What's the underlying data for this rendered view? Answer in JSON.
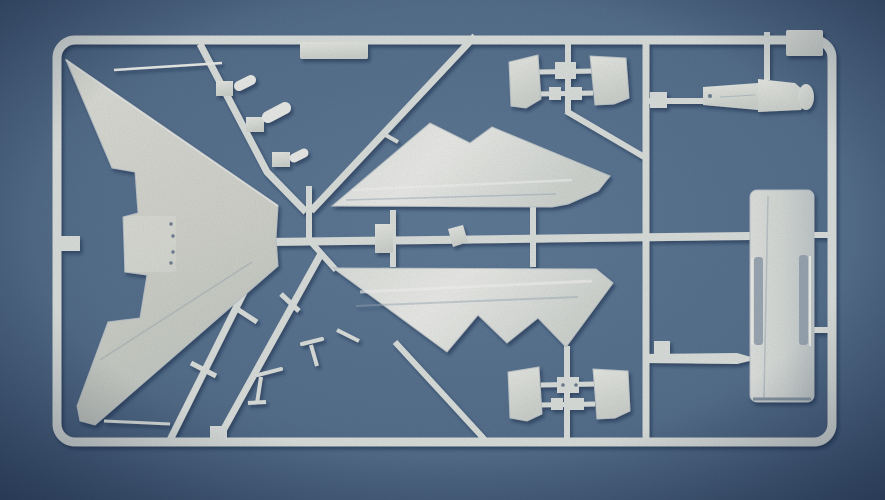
{
  "meta": {
    "subject": "photograph of a white plastic model-kit sprue with aircraft parts on a blue background",
    "parts_visible": [
      "delta-wing",
      "upper-fuselage-half",
      "lower-fuselage-half",
      "intake-ramp-panels",
      "drop-tank-slab",
      "pylon-body",
      "landing-gear-struts",
      "small-clip-parts",
      "sprue-frame-runners"
    ]
  },
  "palette": {
    "plastic": "#e4e9e6",
    "plasticBright": "#f4f6f2",
    "dot": "#76869a",
    "bgCenter": "#64809f",
    "bgMid": "#597492",
    "bgEdge": "#42597a",
    "shadow": "#16294a"
  },
  "shapes": [
    {
      "name": "photo-background",
      "l": "bg",
      "t": "rect",
      "x": 0,
      "y": 0,
      "w": 885,
      "h": 500,
      "f": "bgGrad"
    },
    {
      "name": "sprue-frame-outline",
      "t": "rect",
      "x": 57,
      "y": 40,
      "w": 775,
      "h": 402,
      "rx": 18,
      "f": "none",
      "k": "plastic",
      "sw": 9
    },
    {
      "name": "frame-gate-stub",
      "t": "rect",
      "x": 56,
      "y": 236,
      "w": 24,
      "h": 15,
      "f": "plastic"
    },
    {
      "name": "label-plate",
      "t": "rect",
      "x": 300,
      "y": 42,
      "w": 68,
      "h": 17,
      "rx": 2,
      "f": "partGrad"
    },
    {
      "name": "corner-plate",
      "t": "rect",
      "x": 786,
      "y": 30,
      "w": 37,
      "h": 26,
      "rx": 2,
      "f": "partGrad"
    },
    {
      "name": "runner-diagonal-left",
      "t": "polyline",
      "pts": "200,44 267,172 306,212",
      "sw": 7
    },
    {
      "name": "runner-diagonal-right",
      "t": "line",
      "x1": 475,
      "y1": 36,
      "x2": 311,
      "y2": 211,
      "sw": 7
    },
    {
      "name": "runner-gate-stub-r2",
      "t": "line",
      "x1": 382,
      "y1": 133,
      "x2": 398,
      "y2": 142,
      "sw": 4
    },
    {
      "name": "junction-stub",
      "t": "line",
      "x1": 309,
      "y1": 186,
      "x2": 309,
      "y2": 243,
      "sw": 6
    },
    {
      "name": "runner-main-horizontal",
      "t": "line",
      "x1": 268,
      "y1": 242,
      "x2": 750,
      "y2": 236,
      "sw": 8
    },
    {
      "name": "runner-lower-fuselage-link",
      "t": "line",
      "x1": 310,
      "y1": 241,
      "x2": 336,
      "y2": 270,
      "sw": 6
    },
    {
      "name": "runner-rail-b",
      "t": "line",
      "x1": 322,
      "y1": 252,
      "x2": 220,
      "y2": 436,
      "sw": 7
    },
    {
      "name": "runner-rail-a",
      "t": "line",
      "x1": 265,
      "y1": 250,
      "x2": 170,
      "y2": 440,
      "sw": 7
    },
    {
      "name": "rail-rung-1",
      "t": "line",
      "x1": 281,
      "y1": 294,
      "x2": 299,
      "y2": 311,
      "sw": 5
    },
    {
      "name": "rail-rung-2",
      "t": "line",
      "x1": 237,
      "y1": 309,
      "x2": 257,
      "y2": 322,
      "sw": 5
    },
    {
      "name": "rail-rung-3",
      "t": "line",
      "x1": 191,
      "y1": 363,
      "x2": 216,
      "y2": 376,
      "sw": 5
    },
    {
      "name": "frame-bottom-block",
      "t": "rect",
      "x": 210,
      "y": 426,
      "w": 17,
      "h": 15,
      "f": "plastic"
    },
    {
      "name": "wingtip-gate",
      "t": "line",
      "x1": 104,
      "y1": 421,
      "x2": 170,
      "y2": 424,
      "sw": 3
    },
    {
      "name": "runner-vertical-intake-top",
      "t": "line",
      "x1": 568,
      "y1": 38,
      "x2": 568,
      "y2": 112,
      "sw": 6
    },
    {
      "name": "runner-diag-568-646",
      "t": "line",
      "x1": 566,
      "y1": 111,
      "x2": 646,
      "y2": 158,
      "sw": 6
    },
    {
      "name": "runner-vertical-intake-bottom",
      "t": "line",
      "x1": 567,
      "y1": 346,
      "x2": 567,
      "y2": 441,
      "sw": 6
    },
    {
      "name": "runner-vertical-right",
      "t": "line",
      "x1": 646,
      "y1": 42,
      "x2": 646,
      "y2": 440,
      "sw": 7
    },
    {
      "name": "runner-vertical-pylon",
      "t": "line",
      "x1": 767,
      "y1": 32,
      "x2": 767,
      "y2": 80,
      "sw": 6
    },
    {
      "name": "runner-diag-bottom-right",
      "t": "line",
      "x1": 395,
      "y1": 342,
      "x2": 486,
      "y2": 441,
      "sw": 6
    },
    {
      "name": "fuselage-stub-1",
      "t": "line",
      "x1": 393,
      "y1": 210,
      "x2": 393,
      "y2": 238,
      "sw": 6
    },
    {
      "name": "fuselage-stub-2",
      "t": "line",
      "x1": 393,
      "y1": 242,
      "x2": 393,
      "y2": 267,
      "sw": 6
    },
    {
      "name": "fuselage-stub-3",
      "t": "line",
      "x1": 533,
      "y1": 207,
      "x2": 533,
      "y2": 238,
      "sw": 6
    },
    {
      "name": "fuselage-stub-4",
      "t": "line",
      "x1": 533,
      "y1": 242,
      "x2": 533,
      "y2": 267,
      "sw": 6
    },
    {
      "name": "pylon-stub",
      "t": "line",
      "x1": 648,
      "y1": 101,
      "x2": 704,
      "y2": 101,
      "sw": 6
    },
    {
      "name": "pylon-stub-block",
      "t": "rect",
      "x": 650,
      "y": 92,
      "w": 17,
      "h": 16,
      "f": "plastic"
    },
    {
      "name": "slab-link-top",
      "t": "line",
      "x1": 812,
      "y1": 235,
      "x2": 831,
      "y2": 235,
      "sw": 6
    },
    {
      "name": "slab-link-mid",
      "t": "line",
      "x1": 812,
      "y1": 330,
      "x2": 831,
      "y2": 330,
      "sw": 6
    },
    {
      "name": "missile-runner",
      "t": "polygon",
      "pts": "646,354 737,353 758,359 737,364 646,363",
      "f": "plastic"
    },
    {
      "name": "missile-runner-block",
      "t": "rect",
      "x": 654,
      "y": 341,
      "w": 16,
      "h": 14,
      "f": "plastic"
    },
    {
      "name": "intake-top-bar-1",
      "t": "line",
      "x1": 539,
      "y1": 72,
      "x2": 593,
      "y2": 71,
      "sw": 5
    },
    {
      "name": "intake-top-block-1",
      "t": "rect",
      "x": 555,
      "y": 62,
      "w": 21,
      "h": 17,
      "f": "plastic"
    },
    {
      "name": "intake-top-bar-2",
      "t": "line",
      "x1": 539,
      "y1": 94,
      "x2": 593,
      "y2": 93,
      "sw": 5
    },
    {
      "name": "intake-top-block-2",
      "t": "rect",
      "x": 549,
      "y": 87,
      "w": 12,
      "h": 13,
      "f": "plastic"
    },
    {
      "name": "intake-top-block-3",
      "t": "rect",
      "x": 567,
      "y": 87,
      "w": 15,
      "h": 13,
      "f": "plastic"
    },
    {
      "name": "intake-bottom-bar-1",
      "t": "line",
      "x1": 541,
      "y1": 385,
      "x2": 595,
      "y2": 384,
      "sw": 5
    },
    {
      "name": "intake-bottom-block-1",
      "t": "rect",
      "x": 557,
      "y": 377,
      "w": 22,
      "h": 16,
      "f": "plastic"
    },
    {
      "name": "intake-bottom-bar-2",
      "t": "line",
      "x1": 541,
      "y1": 405,
      "x2": 595,
      "y2": 404,
      "sw": 5
    },
    {
      "name": "intake-bottom-block-2",
      "t": "rect",
      "x": 551,
      "y": 398,
      "w": 12,
      "h": 12,
      "f": "plastic"
    },
    {
      "name": "intake-bottom-block-3",
      "t": "rect",
      "x": 569,
      "y": 398,
      "w": 15,
      "h": 12,
      "f": "plastic"
    },
    {
      "name": "clip-part-1-block",
      "t": "rect",
      "x": 216,
      "y": 81,
      "w": 17,
      "h": 15,
      "f": "partGrad"
    },
    {
      "name": "clip-part-1-nub",
      "t": "line",
      "x1": 239,
      "y1": 86,
      "x2": 251,
      "y2": 80,
      "sw": 10,
      "cap": "round",
      "k": "plasticBright"
    },
    {
      "name": "clip-part-2-block",
      "t": "rect",
      "x": 246,
      "y": 117,
      "w": 18,
      "h": 15,
      "f": "partGrad"
    },
    {
      "name": "clip-part-2-nub",
      "t": "line",
      "x1": 268,
      "y1": 117,
      "x2": 285,
      "y2": 108,
      "sw": 12,
      "cap": "round",
      "k": "plasticBright"
    },
    {
      "name": "clip-part-3-block",
      "t": "rect",
      "x": 272,
      "y": 152,
      "w": 18,
      "h": 15,
      "f": "partGrad"
    },
    {
      "name": "clip-part-3-nub",
      "t": "line",
      "x1": 294,
      "y1": 158,
      "x2": 304,
      "y2": 153,
      "sw": 9,
      "cap": "round",
      "k": "plasticBright"
    },
    {
      "name": "delta-wing-part",
      "t": "polygon",
      "pts": "66,60 278,206 276,238 278,266 95,425 80,421 77,406 108,322 140,318 147,275 125,272 123,217 138,213 135,172 112,168",
      "f": "wingGrad",
      "k": "#c3ccd2",
      "sw": 1
    },
    {
      "name": "wing-center-panel",
      "t": "rect",
      "x": 124,
      "y": 216,
      "w": 52,
      "h": 56,
      "f": "#ffffff",
      "o": 0.22
    },
    {
      "name": "wing-hole-1",
      "t": "circle",
      "cx": 171,
      "cy": 224,
      "r": 1.7,
      "f": "dot"
    },
    {
      "name": "wing-hole-2",
      "t": "circle",
      "cx": 173,
      "cy": 236,
      "r": 1.7,
      "f": "dot"
    },
    {
      "name": "wing-hole-3",
      "t": "circle",
      "cx": 173,
      "cy": 252,
      "r": 1.7,
      "f": "dot"
    },
    {
      "name": "wing-hole-4",
      "t": "circle",
      "cx": 171,
      "cy": 263,
      "r": 1.7,
      "f": "dot"
    },
    {
      "name": "wing-leading-edge-highlight",
      "t": "line",
      "x1": 66,
      "y1": 60,
      "x2": 278,
      "y2": 206,
      "k": "#f8faf6",
      "sw": 2,
      "o": 0.75
    },
    {
      "name": "wing-crease",
      "t": "line",
      "x1": 100,
      "y1": 360,
      "x2": 252,
      "y2": 262,
      "k": "#8fa0b0",
      "sw": 1.5,
      "o": 0.35
    },
    {
      "name": "pitot-probe-part",
      "t": "line",
      "x1": 114,
      "y1": 70,
      "x2": 222,
      "y2": 63,
      "sw": 2.5,
      "k": "plasticBright"
    },
    {
      "name": "upper-fuselage-half-part",
      "t": "polygon",
      "pts": "332,206 430,123 470,143 492,127 610,176 598,191 568,204 552,207",
      "f": "sheenGrad",
      "k": "#c9d1d5",
      "sw": 1
    },
    {
      "name": "upper-fuselage-sheen",
      "t": "line",
      "x1": 352,
      "y1": 190,
      "x2": 572,
      "y2": 180,
      "k": "#ffffff",
      "sw": 2.5,
      "o": 0.55
    },
    {
      "name": "upper-fuselage-shadow-line",
      "t": "line",
      "x1": 346,
      "y1": 200,
      "x2": 556,
      "y2": 194,
      "k": "#9fb0bd",
      "sw": 1.5,
      "o": 0.5
    },
    {
      "name": "scoop-part",
      "t": "polygon",
      "pts": "448,229 463,225 468,242 453,247",
      "f": "partGrad"
    },
    {
      "name": "junction-block-part",
      "t": "rect",
      "x": 375,
      "y": 224,
      "w": 18,
      "h": 29,
      "f": "partGrad"
    },
    {
      "name": "lower-fuselage-half-part",
      "t": "polygon",
      "pts": "333,268 596,269 613,283 566,347 538,318 507,343 478,315 447,352",
      "f": "sheenGrad",
      "k": "#c9d1d5",
      "sw": 1
    },
    {
      "name": "lower-fuselage-sheen",
      "t": "line",
      "x1": 360,
      "y1": 292,
      "x2": 592,
      "y2": 281,
      "k": "#ffffff",
      "sw": 3,
      "o": 0.6
    },
    {
      "name": "lower-fuselage-shadow-line",
      "t": "line",
      "x1": 356,
      "y1": 306,
      "x2": 578,
      "y2": 297,
      "k": "#9fb0bd",
      "sw": 2,
      "o": 0.45
    },
    {
      "name": "intake-panel-top-left",
      "t": "polygon",
      "pts": "509,62 538,55 541,99 526,108 511,106",
      "f": "partGrad",
      "k": "#c9d1d5",
      "sw": 1
    },
    {
      "name": "intake-panel-top-right",
      "t": "polygon",
      "pts": "590,56 626,58 629,98 614,104 595,105",
      "f": "partGrad",
      "k": "#c9d1d5",
      "sw": 1
    },
    {
      "name": "intake-panel-bottom-left",
      "t": "polygon",
      "pts": "508,372 539,367 542,414 527,421 510,418",
      "f": "partGrad",
      "k": "#c9d1d5",
      "sw": 1
    },
    {
      "name": "intake-panel-bottom-right",
      "t": "polygon",
      "pts": "593,369 628,371 630,411 615,418 597,419",
      "f": "partGrad",
      "k": "#c9d1d5",
      "sw": 1
    },
    {
      "name": "intake-hole-1",
      "t": "circle",
      "cx": 563,
      "cy": 385,
      "r": 1.8,
      "f": "dot"
    },
    {
      "name": "intake-hole-2",
      "t": "circle",
      "cx": 576,
      "cy": 385,
      "r": 1.8,
      "f": "dot"
    },
    {
      "name": "pylon-bar-part",
      "t": "polygon",
      "pts": "703,87 758,83 758,110 703,105",
      "f": "partGrad"
    },
    {
      "name": "pylon-hole",
      "t": "circle",
      "cx": 710,
      "cy": 96,
      "r": 2,
      "f": "dot"
    },
    {
      "name": "pylon-body-part",
      "t": "polygon",
      "pts": "758,79 795,83 803,90 806,100 801,110 758,112",
      "f": "partGrad"
    },
    {
      "name": "pylon-nose",
      "t": "ellipse",
      "cx": 806,
      "cy": 97,
      "erx": 8,
      "ery": 13,
      "f": "partGrad"
    },
    {
      "name": "pylon-detail-line",
      "t": "line",
      "x1": 720,
      "y1": 97,
      "x2": 755,
      "y2": 95,
      "k": "#9fb0bd",
      "sw": 1,
      "o": 0.6
    },
    {
      "name": "drop-tank-slab-part",
      "t": "rect",
      "x": 750,
      "y": 190,
      "w": 64,
      "h": 212,
      "rx": 7,
      "f": "slabGrad",
      "k": "#c3ccd2",
      "sw": 1
    },
    {
      "name": "slab-groove-left",
      "t": "rect",
      "x": 754,
      "y": 257,
      "w": 9,
      "h": 88,
      "rx": 3,
      "f": "#96a5b4",
      "o": 0.85
    },
    {
      "name": "slab-groove-right",
      "t": "rect",
      "x": 799,
      "y": 255,
      "w": 9,
      "h": 90,
      "rx": 3,
      "f": "#96a5b4",
      "o": 0.85
    },
    {
      "name": "slab-strip-left",
      "t": "line",
      "x1": 752,
      "y1": 258,
      "x2": 752,
      "y2": 345,
      "k": "#f6f8f4",
      "sw": 2
    },
    {
      "name": "slab-strip-right",
      "t": "line",
      "x1": 810,
      "y1": 256,
      "x2": 810,
      "y2": 346,
      "k": "#f6f8f4",
      "sw": 2
    },
    {
      "name": "slab-seam",
      "t": "line",
      "x1": 768,
      "y1": 196,
      "x2": 764,
      "y2": 398,
      "k": "#b4bfc6",
      "sw": 1.5,
      "o": 0.7
    },
    {
      "name": "slab-bottom-edge",
      "t": "line",
      "x1": 753,
      "y1": 399,
      "x2": 811,
      "y2": 399,
      "k": "#8d9cab",
      "sw": 3
    },
    {
      "name": "gear-strut-1-arm",
      "t": "line",
      "x1": 258,
      "y1": 375,
      "x2": 281,
      "y2": 369,
      "sw": 4,
      "cap": "round"
    },
    {
      "name": "gear-strut-1-leg",
      "t": "line",
      "x1": 261,
      "y1": 377,
      "x2": 257,
      "y2": 403,
      "sw": 4
    },
    {
      "name": "gear-strut-1-foot",
      "t": "line",
      "x1": 248,
      "y1": 403,
      "x2": 266,
      "y2": 402,
      "sw": 4
    },
    {
      "name": "gear-strut-2-arm",
      "t": "line",
      "x1": 302,
      "y1": 344,
      "x2": 322,
      "y2": 339,
      "sw": 4,
      "cap": "round"
    },
    {
      "name": "gear-strut-2-leg",
      "t": "line",
      "x1": 311,
      "y1": 345,
      "x2": 317,
      "y2": 366,
      "sw": 4
    },
    {
      "name": "small-strut-part",
      "t": "line",
      "x1": 337,
      "y1": 330,
      "x2": 359,
      "y2": 341,
      "sw": 4
    },
    {
      "name": "photo-vignette",
      "l": "fx",
      "t": "rect",
      "x": 0,
      "y": 0,
      "w": 885,
      "h": 500,
      "f": "vignGrad"
    },
    {
      "name": "photo-grain",
      "l": "fx",
      "t": "rect",
      "x": 0,
      "y": 0,
      "w": 885,
      "h": 500,
      "f": "#0a1830",
      "flt": "grainF",
      "o": 0.16
    }
  ]
}
